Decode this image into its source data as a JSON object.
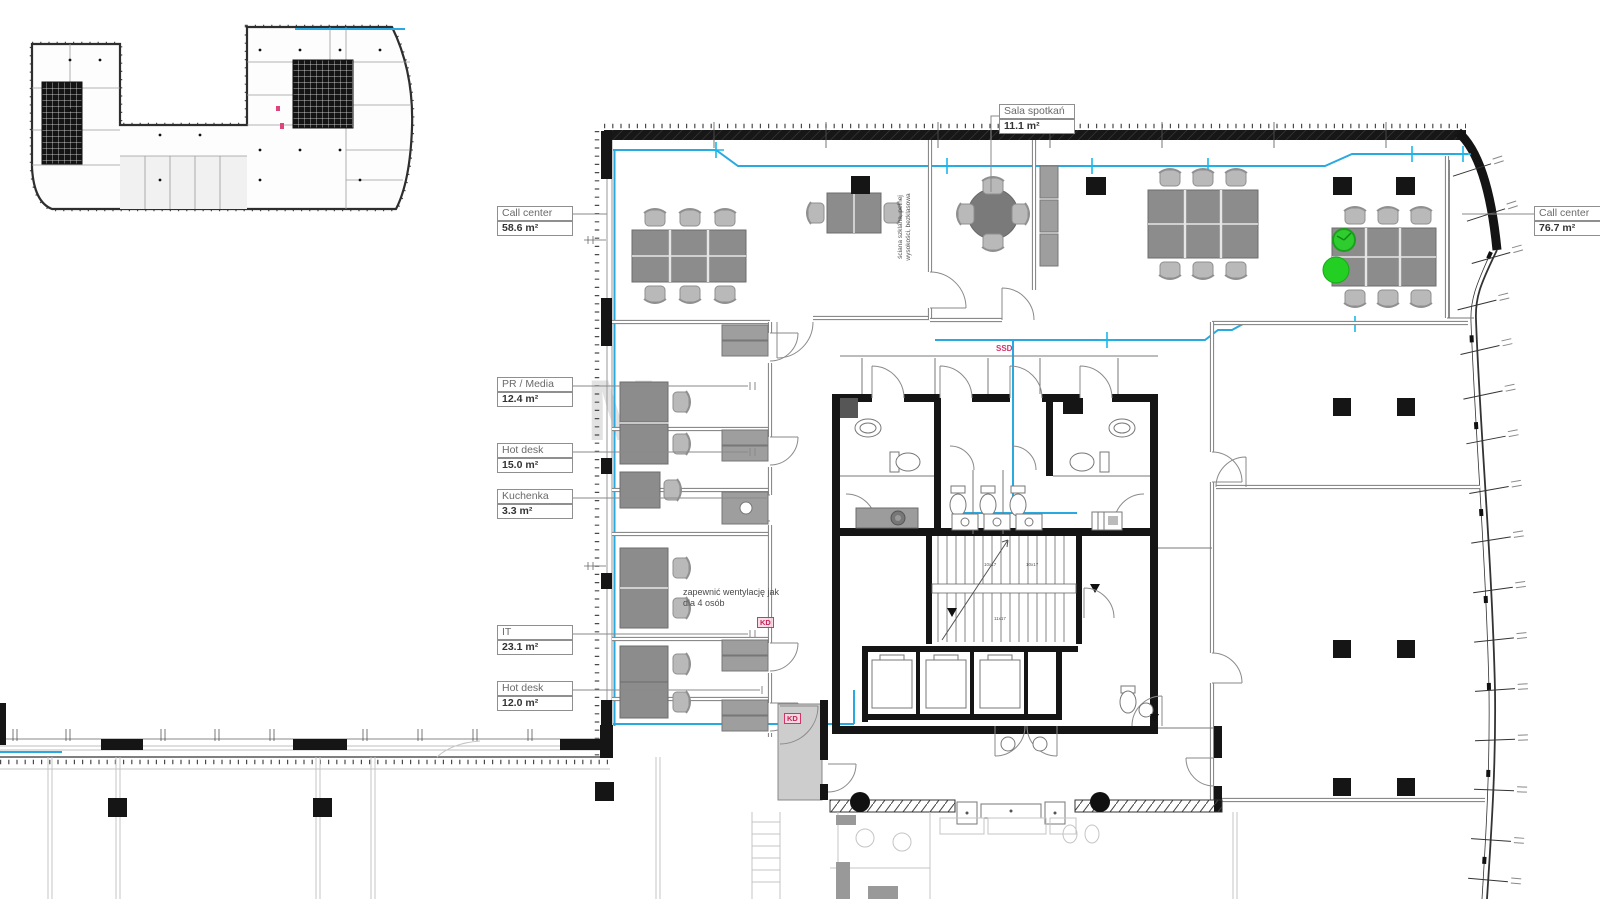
{
  "labels": {
    "sala": {
      "name": "Sala spotkań",
      "area": "11.1 m²"
    },
    "call_left": {
      "name": "Call center",
      "area": "58.6 m²"
    },
    "pr": {
      "name": "PR / Media",
      "area": "12.4 m²"
    },
    "hot15": {
      "name": "Hot desk",
      "area": "15.0 m²"
    },
    "kuchenka": {
      "name": "Kuchenka",
      "area": "3.3  m²"
    },
    "it": {
      "name": "IT",
      "area": "23.1 m²"
    },
    "hot12": {
      "name": "Hot desk",
      "area": "12.0 m²"
    },
    "call_right": {
      "name": "Call center",
      "area": "76.7 m²"
    }
  },
  "notes": {
    "ventilation_line1": "zapewnić wentylację jak",
    "ventilation_line2": "dla 4 osób",
    "glass_wall_line1": "ściana szklana, pełnej",
    "glass_wall_line2": "wysokości, bezklasowa"
  },
  "markers": {
    "ssd": "SSD",
    "kd": "KD"
  },
  "stairs": {
    "flight_a": "10x17",
    "flight_b": "10x17",
    "flight_c": "11x17"
  },
  "watermark": "M",
  "colors": {
    "glazing_blue": "#29A9DF",
    "highlight_green": "#23CD23",
    "marker_red": "#D6336C",
    "wall_black": "#151515"
  }
}
